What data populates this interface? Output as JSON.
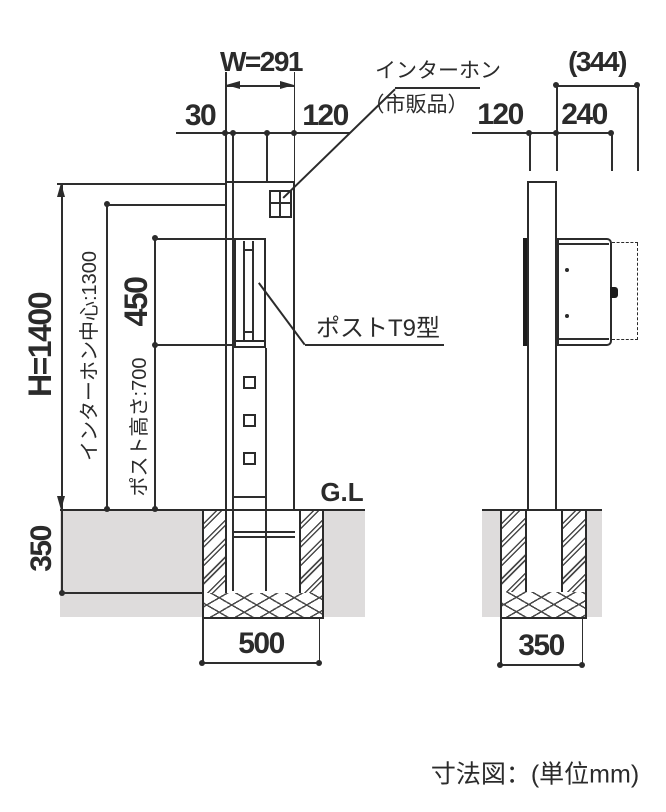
{
  "drawing": {
    "caption": "寸法図：(単位mm)",
    "colors": {
      "line": "#2b2b2b",
      "soil": "#dedcdc"
    },
    "front": {
      "width": "W=291",
      "frame_offset": "30",
      "intercom_area_width": "120",
      "height": "H=1400",
      "intercom_center": "インターホン中心:1300",
      "post_unit_height": "450",
      "post_height": "ポスト高さ:700",
      "embed_depth": "350",
      "footing_width": "500",
      "ground_label": "G.L",
      "intercom_label": "インターホン",
      "intercom_note": "（市販品）",
      "post_label": "ポストT9型"
    },
    "side": {
      "overall_depth": "(344)",
      "pole_depth": "120",
      "box_depth": "240",
      "footing_width": "350"
    }
  }
}
